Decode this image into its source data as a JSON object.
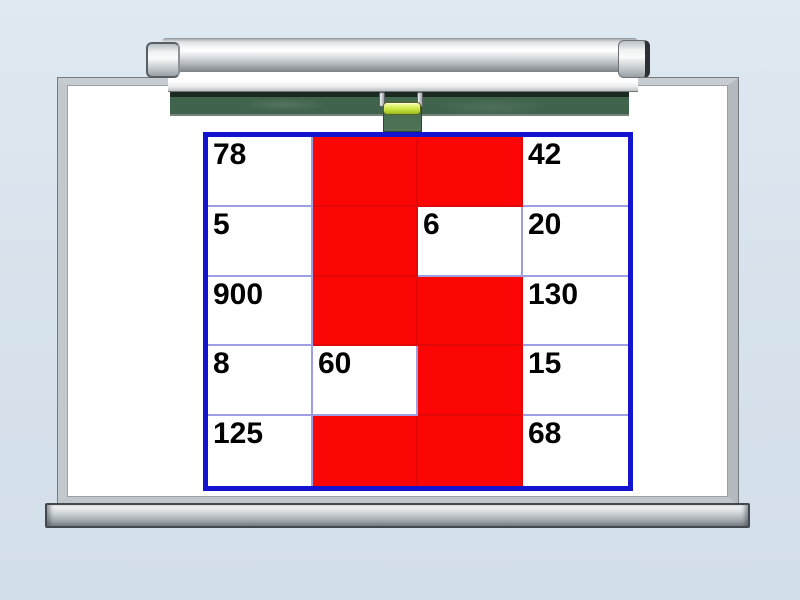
{
  "slide": {
    "background_color": "#d8e3ec"
  },
  "whiteboard": {
    "surface_color": "#ffffff",
    "frame_color": "#bfc5ca",
    "tray_color": "#b9c0c4"
  },
  "projection_screen": {
    "roller_color": "#d9dde0",
    "fabric_color": "#ffffff"
  },
  "chalkboard": {
    "strip_color": "#40644b",
    "pull_tab_color": "#497053",
    "handle_grip_color": "#cde94f",
    "bracket_color": "#c7ccd0"
  },
  "number_grid": {
    "type": "table",
    "columns": 4,
    "rows_count": 5,
    "border_color": "#1414cf",
    "grid_line_color": "#9e9ee2",
    "covered_color": "#fb0505",
    "text_color": "#000000",
    "covered_shape": "5",
    "rows": [
      {
        "cells": [
          {
            "text": "78",
            "state": "white"
          },
          {
            "text": "",
            "state": "red"
          },
          {
            "text": "",
            "state": "red"
          },
          {
            "text": "42",
            "state": "white"
          }
        ]
      },
      {
        "cells": [
          {
            "text": "5",
            "state": "white"
          },
          {
            "text": "",
            "state": "red"
          },
          {
            "text": "6",
            "state": "white"
          },
          {
            "text": "20",
            "state": "white"
          }
        ]
      },
      {
        "cells": [
          {
            "text": "900",
            "state": "white"
          },
          {
            "text": "",
            "state": "red"
          },
          {
            "text": "",
            "state": "red"
          },
          {
            "text": "130",
            "state": "white"
          }
        ]
      },
      {
        "cells": [
          {
            "text": "8",
            "state": "white"
          },
          {
            "text": "60",
            "state": "white"
          },
          {
            "text": "",
            "state": "red"
          },
          {
            "text": "15",
            "state": "white"
          }
        ]
      },
      {
        "cells": [
          {
            "text": "125",
            "state": "white"
          },
          {
            "text": "",
            "state": "red"
          },
          {
            "text": "",
            "state": "red"
          },
          {
            "text": "68",
            "state": "white"
          }
        ]
      }
    ]
  }
}
